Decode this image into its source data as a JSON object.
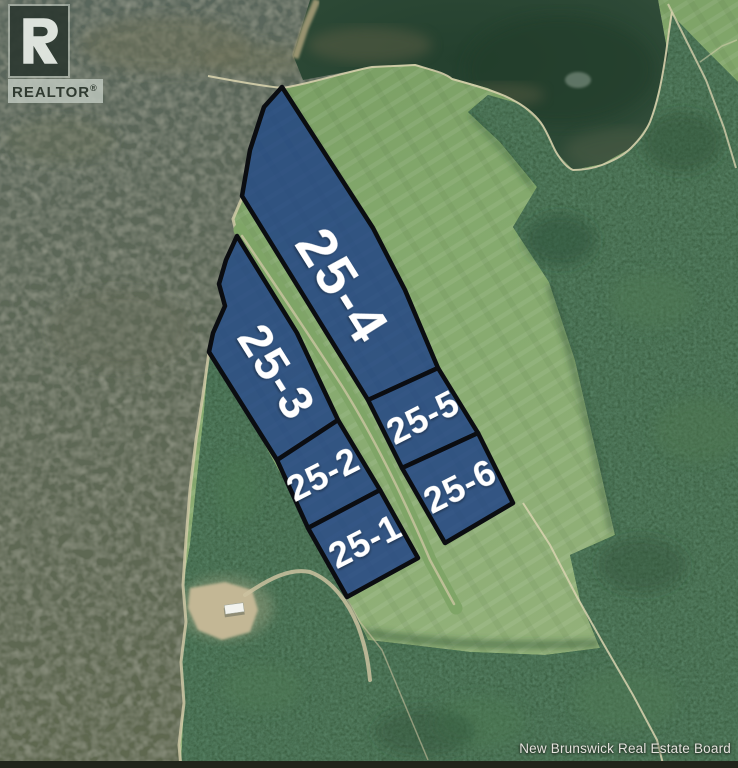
{
  "canvas": {
    "width": 738,
    "height": 768
  },
  "watermark": {
    "symbol": "R",
    "label": "REALTOR",
    "registered": "®"
  },
  "attribution": {
    "text": "New Brunswick Real Estate Board"
  },
  "palette": {
    "lot_fill": "rgba(25,60,135,0.78)",
    "lot_border": "#0b0d11",
    "lot_label_color": "#ffffff",
    "water": "#5d675a",
    "pond": "#2b4634",
    "field": "#85aa6e",
    "forest": "#3d6244",
    "trail": "#d8d2ae",
    "clearing": "#c3b795"
  },
  "lots": [
    {
      "id": "25-4",
      "label": "25-4",
      "points": "282,87 264,107 250,150 242,196 368,400 438,368 405,290 373,228",
      "label_x": 343,
      "label_y": 286,
      "rotate": 58,
      "font_size": 56,
      "letter_spacing": 3
    },
    {
      "id": "25-3",
      "label": "25-3",
      "points": "237,236 226,260 219,284 225,306 213,333 209,352 277,460 338,420 297,333",
      "label_x": 277,
      "label_y": 372,
      "rotate": 58,
      "font_size": 47,
      "letter_spacing": 2
    },
    {
      "id": "25-5",
      "label": "25-5",
      "points": "368,400 438,368 478,433 402,468",
      "label_x": 423,
      "label_y": 417,
      "rotate": -27,
      "font_size": 36,
      "letter_spacing": 1
    },
    {
      "id": "25-6",
      "label": "25-6",
      "points": "402,468 478,433 513,503 445,543",
      "label_x": 460,
      "label_y": 486,
      "rotate": -27,
      "font_size": 36,
      "letter_spacing": 1
    },
    {
      "id": "25-2",
      "label": "25-2",
      "points": "277,460 338,420 380,490 308,528",
      "label_x": 323,
      "label_y": 474,
      "rotate": -27,
      "font_size": 36,
      "letter_spacing": 1
    },
    {
      "id": "25-1",
      "label": "25-1",
      "points": "308,528 380,490 418,558 347,597",
      "label_x": 365,
      "label_y": 541,
      "rotate": -27,
      "font_size": 36,
      "letter_spacing": 1
    }
  ]
}
